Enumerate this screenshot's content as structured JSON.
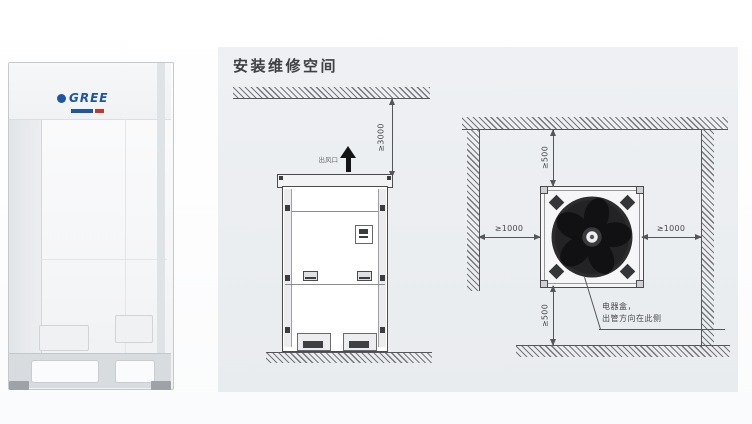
{
  "photo": {
    "brand": "GREE"
  },
  "panel": {
    "title": "安装维修空间",
    "front_view": {
      "air_outlet_label": "出风口",
      "top_clearance_label": "≥3000"
    },
    "top_view": {
      "left_clearance_label": "≥1000",
      "right_clearance_label": "≥1000",
      "top_clearance_label": "≥500",
      "bottom_clearance_label": "≥500",
      "note_line1": "电器盒，",
      "note_line2": "出管方向在此侧"
    }
  },
  "colors": {
    "panel_bg": "#edf0f2",
    "line": "#55565a",
    "brand_blue": "#1f55a5",
    "accent_red": "#c0392b"
  }
}
